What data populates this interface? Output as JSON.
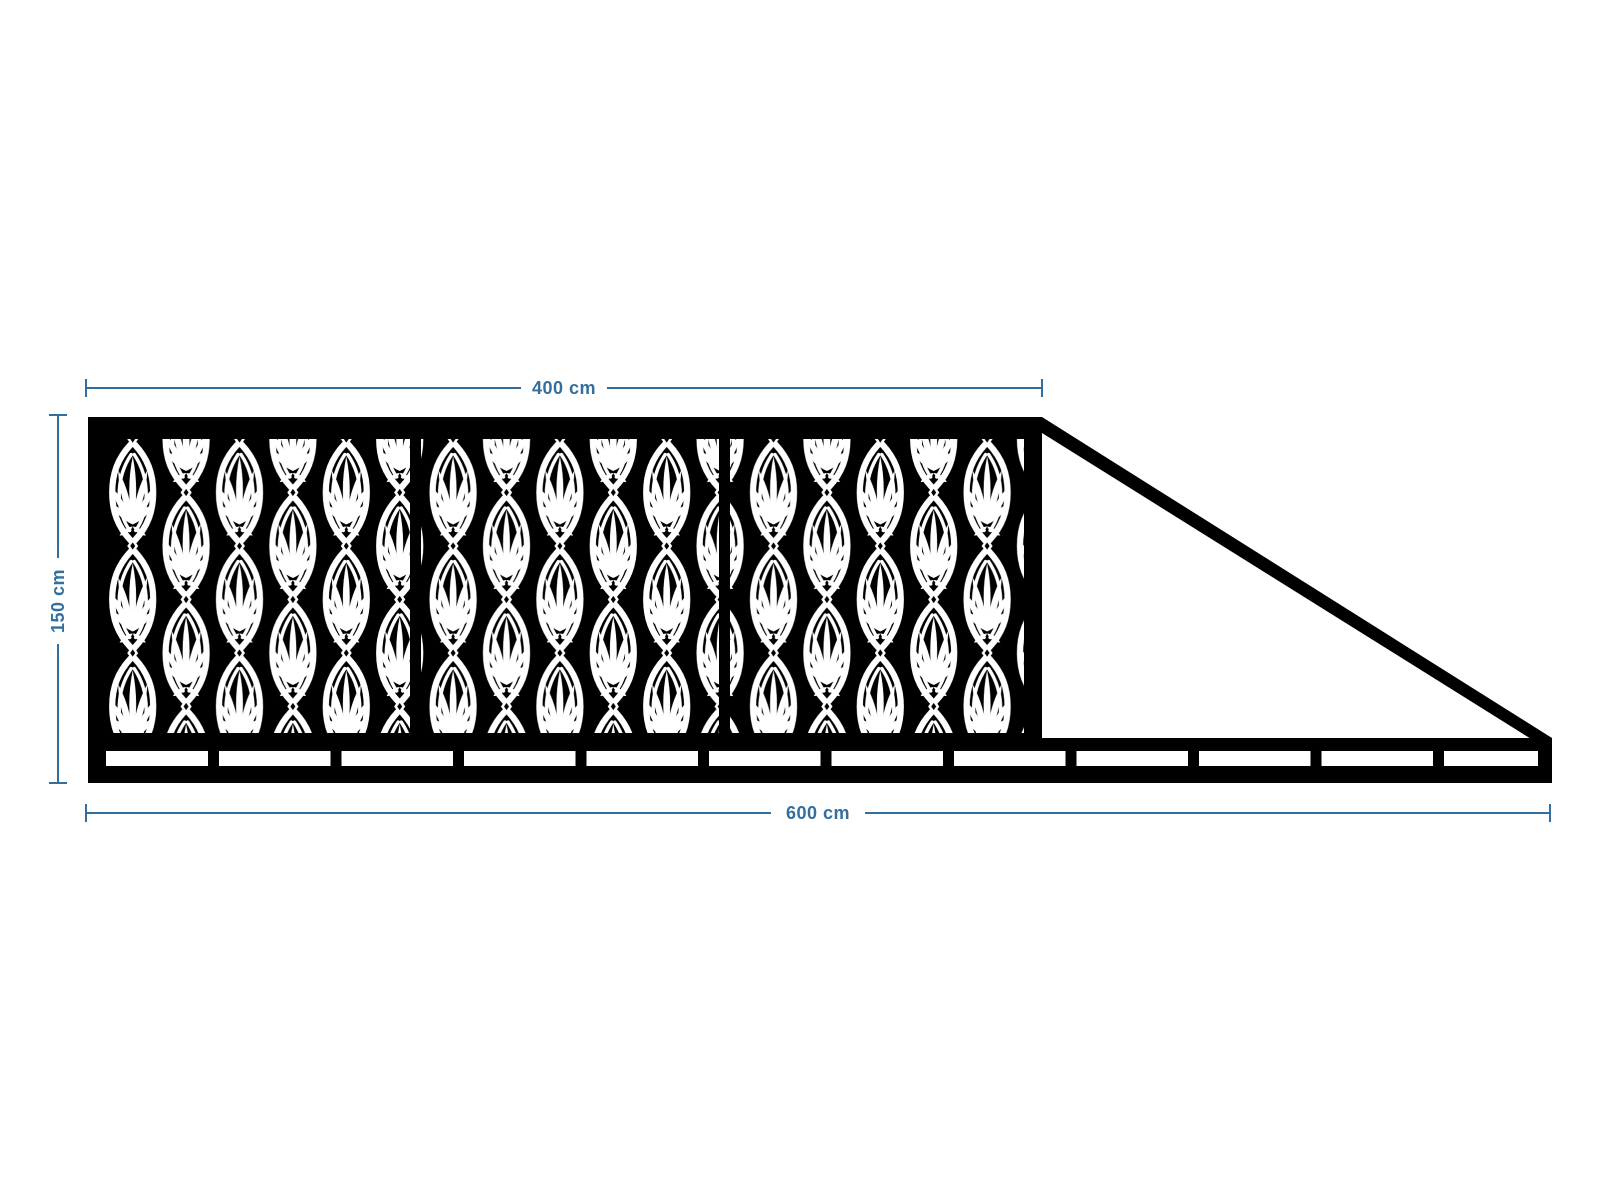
{
  "colors": {
    "background": "#ffffff",
    "structure": "#000000",
    "pattern_cut": "#ffffff",
    "dimension": "#336e9e"
  },
  "drawing": {
    "description": "Cantilever sliding gate, front elevation, with decorative laser-cut palmette panels",
    "gate": {
      "panel_count": 3,
      "infill": "palmette-damask-pattern"
    },
    "dimensions": {
      "top": {
        "label": "400 cm",
        "orientation": "horizontal"
      },
      "left": {
        "label": "150 cm",
        "orientation": "vertical"
      },
      "bottom": {
        "label": "600 cm",
        "orientation": "horizontal"
      }
    }
  }
}
